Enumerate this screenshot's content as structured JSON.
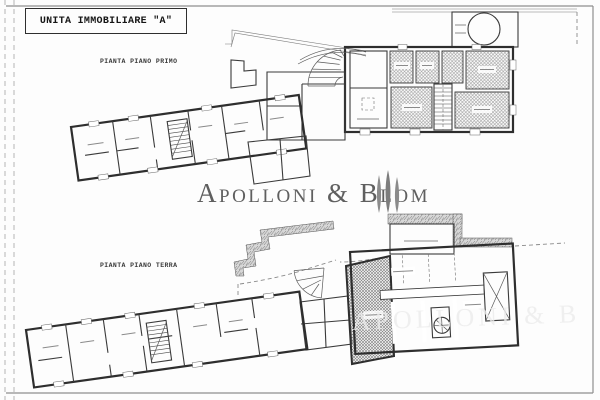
{
  "title_block": {
    "label": "UNITA IMMOBILIARE \"A\""
  },
  "plans": {
    "first_floor": {
      "label": "PIANTA PIANO PRIMO"
    },
    "ground_floor": {
      "label": "PIANTA PIANO TERRA"
    }
  },
  "watermark": {
    "brand": "Apolloni & Blom",
    "fragment": "APOLLONI & B",
    "text_color": "#5f5f5f",
    "tree_color": "#8b8b8b"
  },
  "drawing_colors": {
    "ink": "#2e2e2e",
    "hatch": "#8a8a8a",
    "paper": "#fdfdfd",
    "frame": "#8f8f8f"
  }
}
